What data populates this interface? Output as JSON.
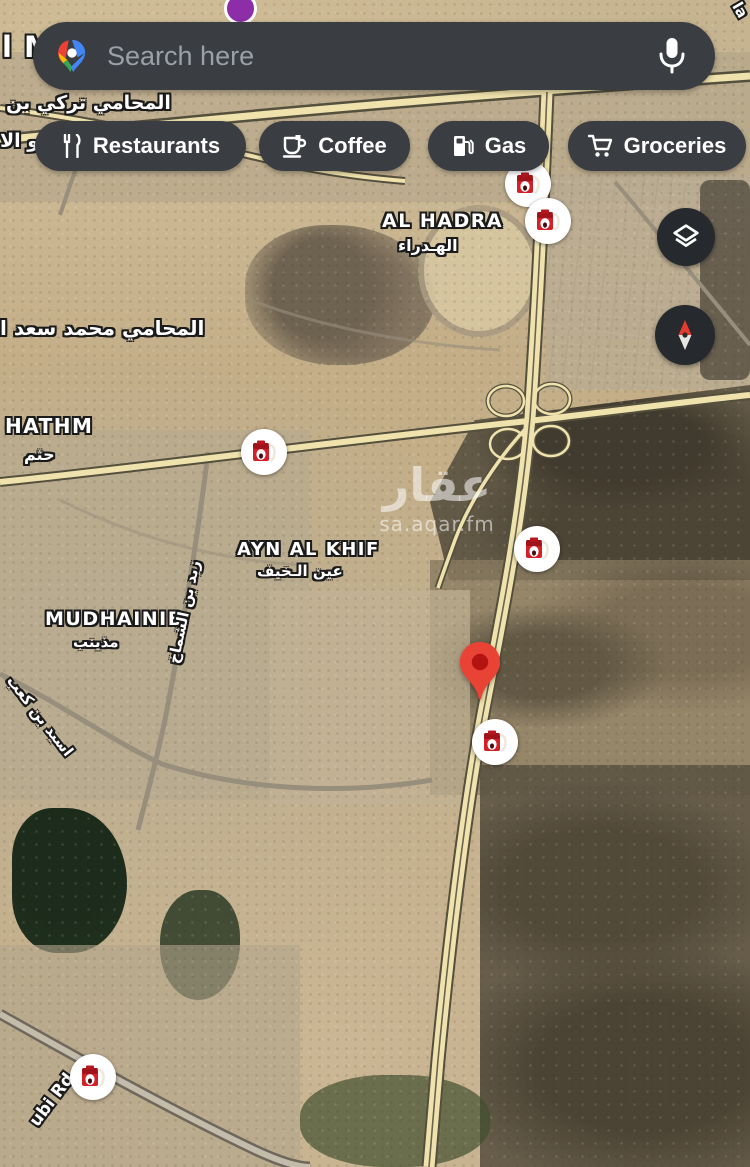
{
  "search": {
    "placeholder": "Search here",
    "logo_icon": "google-maps-logo",
    "mic_icon": "microphone-icon"
  },
  "chips": [
    {
      "label": "Restaurants",
      "icon": "restaurants-icon",
      "left": 35,
      "width": 211
    },
    {
      "label": "Coffee",
      "icon": "coffee-icon",
      "left": 259,
      "width": 151
    },
    {
      "label": "Gas",
      "icon": "gas-icon",
      "left": 428,
      "width": 121
    },
    {
      "label": "Groceries",
      "icon": "groceries-icon",
      "left": 568,
      "width": 178
    }
  ],
  "map_controls": {
    "layers_icon": "layers-icon",
    "compass_icon": "compass-icon"
  },
  "colors": {
    "chip_bg": "#3a3d41",
    "placeholder": "#9aa0a6",
    "pin_red": "#e94335",
    "pin_inner": "#b31412",
    "pump_red": "#d51f26",
    "highway_fill": "#efe2ad",
    "highway_edge": "#55503e",
    "poi_purple": "#8d2da8"
  },
  "map": {
    "labels": [
      {
        "text": "l Madinah M",
        "kind": "city",
        "x": 2,
        "y": 30,
        "size": 29,
        "z": 5
      },
      {
        "text": "المحامي تركي بن",
        "kind": "arabic",
        "x": 6,
        "y": 92,
        "size": 19,
        "z": 15
      },
      {
        "text": "و الا",
        "kind": "arabic",
        "x": 0,
        "y": 130,
        "size": 19,
        "z": 15
      },
      {
        "text": "AL HADRA",
        "kind": "district",
        "x": 382,
        "y": 210,
        "size": 19,
        "z": 15
      },
      {
        "text": "الهـدراء",
        "kind": "arabic",
        "x": 398,
        "y": 236,
        "size": 16,
        "z": 15
      },
      {
        "text": "المحامي محمد سعد ا",
        "kind": "arabic",
        "x": 0,
        "y": 316,
        "size": 20,
        "z": 15
      },
      {
        "text": "HATHM",
        "kind": "district",
        "x": 5,
        "y": 414,
        "size": 20,
        "z": 15
      },
      {
        "text": "حثم",
        "kind": "arabic",
        "x": 24,
        "y": 445,
        "size": 16,
        "z": 15
      },
      {
        "text": "AYN AL KHIF",
        "kind": "district",
        "x": 237,
        "y": 539,
        "size": 18,
        "z": 15
      },
      {
        "text": "عين الـخيف",
        "kind": "arabic",
        "x": 257,
        "y": 562,
        "size": 15,
        "z": 15
      },
      {
        "text": "MUDHAINIB",
        "kind": "district",
        "x": 45,
        "y": 608,
        "size": 19,
        "z": 15
      },
      {
        "text": "مذينب",
        "kind": "arabic",
        "x": 73,
        "y": 633,
        "size": 15,
        "z": 15
      },
      {
        "text": "زيد بن الشماخ",
        "kind": "street",
        "cx": 184,
        "cy": 612,
        "size": 15,
        "rotate": -78,
        "z": 15
      },
      {
        "text": "اسيد بن كعب",
        "kind": "street",
        "cx": 40,
        "cy": 716,
        "size": 15,
        "rotate": 52,
        "z": 15
      },
      {
        "text": "ubi Rd",
        "kind": "street",
        "cx": 52,
        "cy": 1100,
        "size": 17,
        "rotate": -53,
        "z": 15
      },
      {
        "text": "la",
        "kind": "street",
        "cx": 740,
        "cy": 10,
        "size": 15,
        "rotate": 60,
        "z": 15
      }
    ],
    "watermark": {
      "line1": "عقار",
      "line2": "sa.aqar.fm"
    },
    "gas_markers": [
      {
        "x": 528,
        "y": 184
      },
      {
        "x": 548,
        "y": 221
      },
      {
        "x": 264,
        "y": 452
      },
      {
        "x": 537,
        "y": 549
      },
      {
        "x": 495,
        "y": 742
      },
      {
        "x": 93,
        "y": 1077
      }
    ],
    "pin": {
      "x": 480,
      "y": 707
    },
    "partial_poi": {
      "x": 237,
      "y": 5
    }
  }
}
